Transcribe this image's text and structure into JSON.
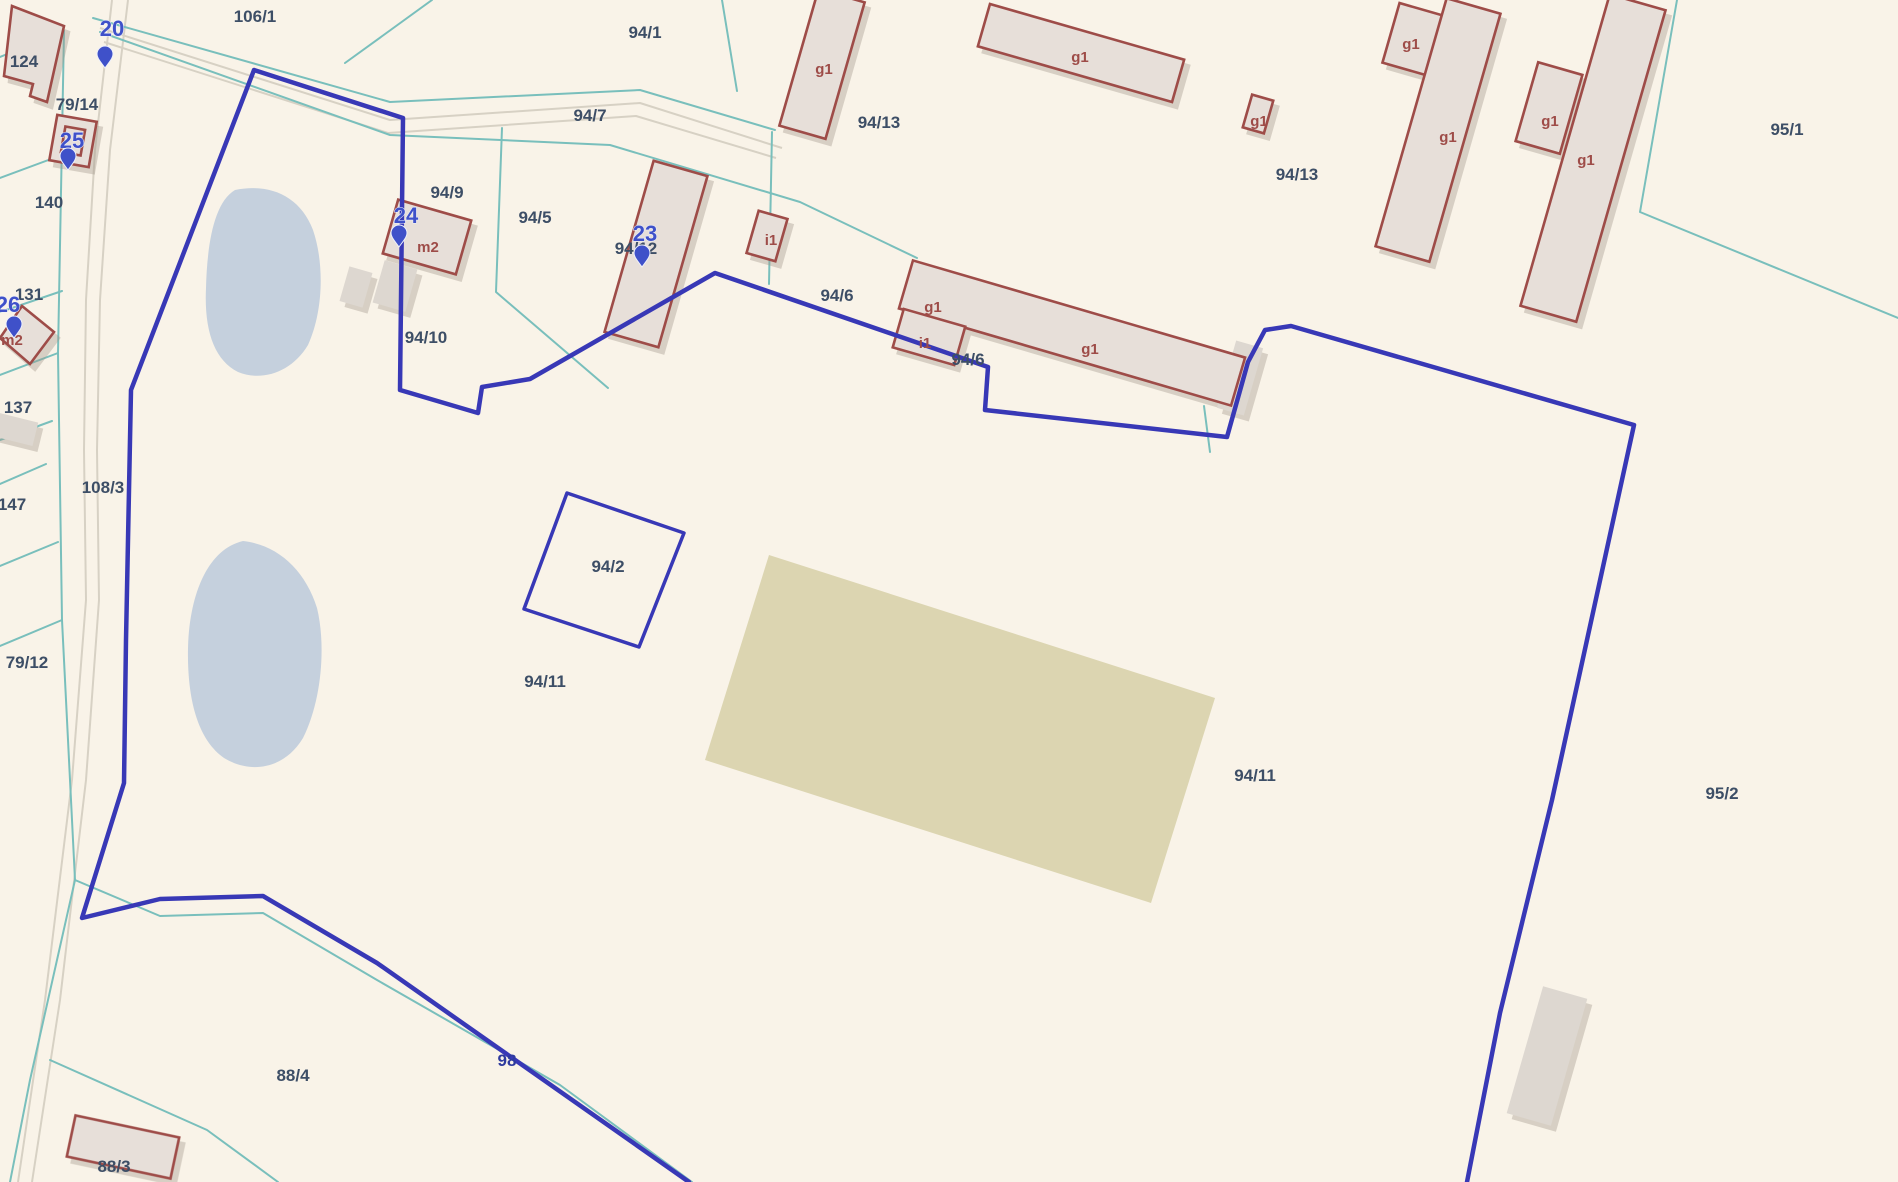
{
  "app": {
    "title": "Cadastral parcel map view"
  },
  "colors": {
    "background": "#f9f3e8",
    "boundary_blue": "#3838b6",
    "parcel_line_teal": "#79bfbc",
    "building_outline_red": "#9e4c48",
    "building_fill": "#e7dfd9",
    "building_label_red": "#9e4c48",
    "parcel_label_slate": "#3d4e66",
    "road_parcel_navy": "#2e3a9e",
    "marker_blue": "#3f51c9",
    "water_fill": "#c5d0dd",
    "landuse_tan": "#dcd5b1",
    "road_line_gray": "#d7d1c4"
  },
  "map": {
    "parcel_labels": [
      {
        "text": "106/1"
      },
      {
        "text": "94/1"
      },
      {
        "text": "124"
      },
      {
        "text": "79/14"
      },
      {
        "text": "140"
      },
      {
        "text": "131"
      },
      {
        "text": "137"
      },
      {
        "text": "147"
      },
      {
        "text": "108/3"
      },
      {
        "text": "79/12"
      },
      {
        "text": "94/7"
      },
      {
        "text": "94/9"
      },
      {
        "text": "94/5"
      },
      {
        "text": "94/12"
      },
      {
        "text": "94/10"
      },
      {
        "text": "94/13"
      },
      {
        "text": "94/13"
      },
      {
        "text": "94/6"
      },
      {
        "text": "94/6"
      },
      {
        "text": "94/2"
      },
      {
        "text": "94/11"
      },
      {
        "text": "94/11"
      },
      {
        "text": "95/1"
      },
      {
        "text": "95/2"
      },
      {
        "text": "88/4"
      },
      {
        "text": "88/3"
      },
      {
        "text": "98"
      }
    ],
    "building_labels": [
      {
        "text": "g1"
      },
      {
        "text": "g1"
      },
      {
        "text": "g1"
      },
      {
        "text": "g1"
      },
      {
        "text": "g1"
      },
      {
        "text": "g1"
      },
      {
        "text": "g1"
      },
      {
        "text": "g1"
      },
      {
        "text": "g1"
      },
      {
        "text": "i1"
      },
      {
        "text": "i1"
      },
      {
        "text": "m2"
      },
      {
        "text": "m2"
      }
    ],
    "address_markers": [
      {
        "text": "20"
      },
      {
        "text": "25"
      },
      {
        "text": "26"
      },
      {
        "text": "24"
      },
      {
        "text": "23"
      }
    ],
    "water_bodies": [
      "pond-north",
      "pond-south"
    ],
    "landuse_area": "tan-cropland-patch",
    "selected_boundary": "blue outlined parcel group (94/11, 94/2 island)"
  }
}
